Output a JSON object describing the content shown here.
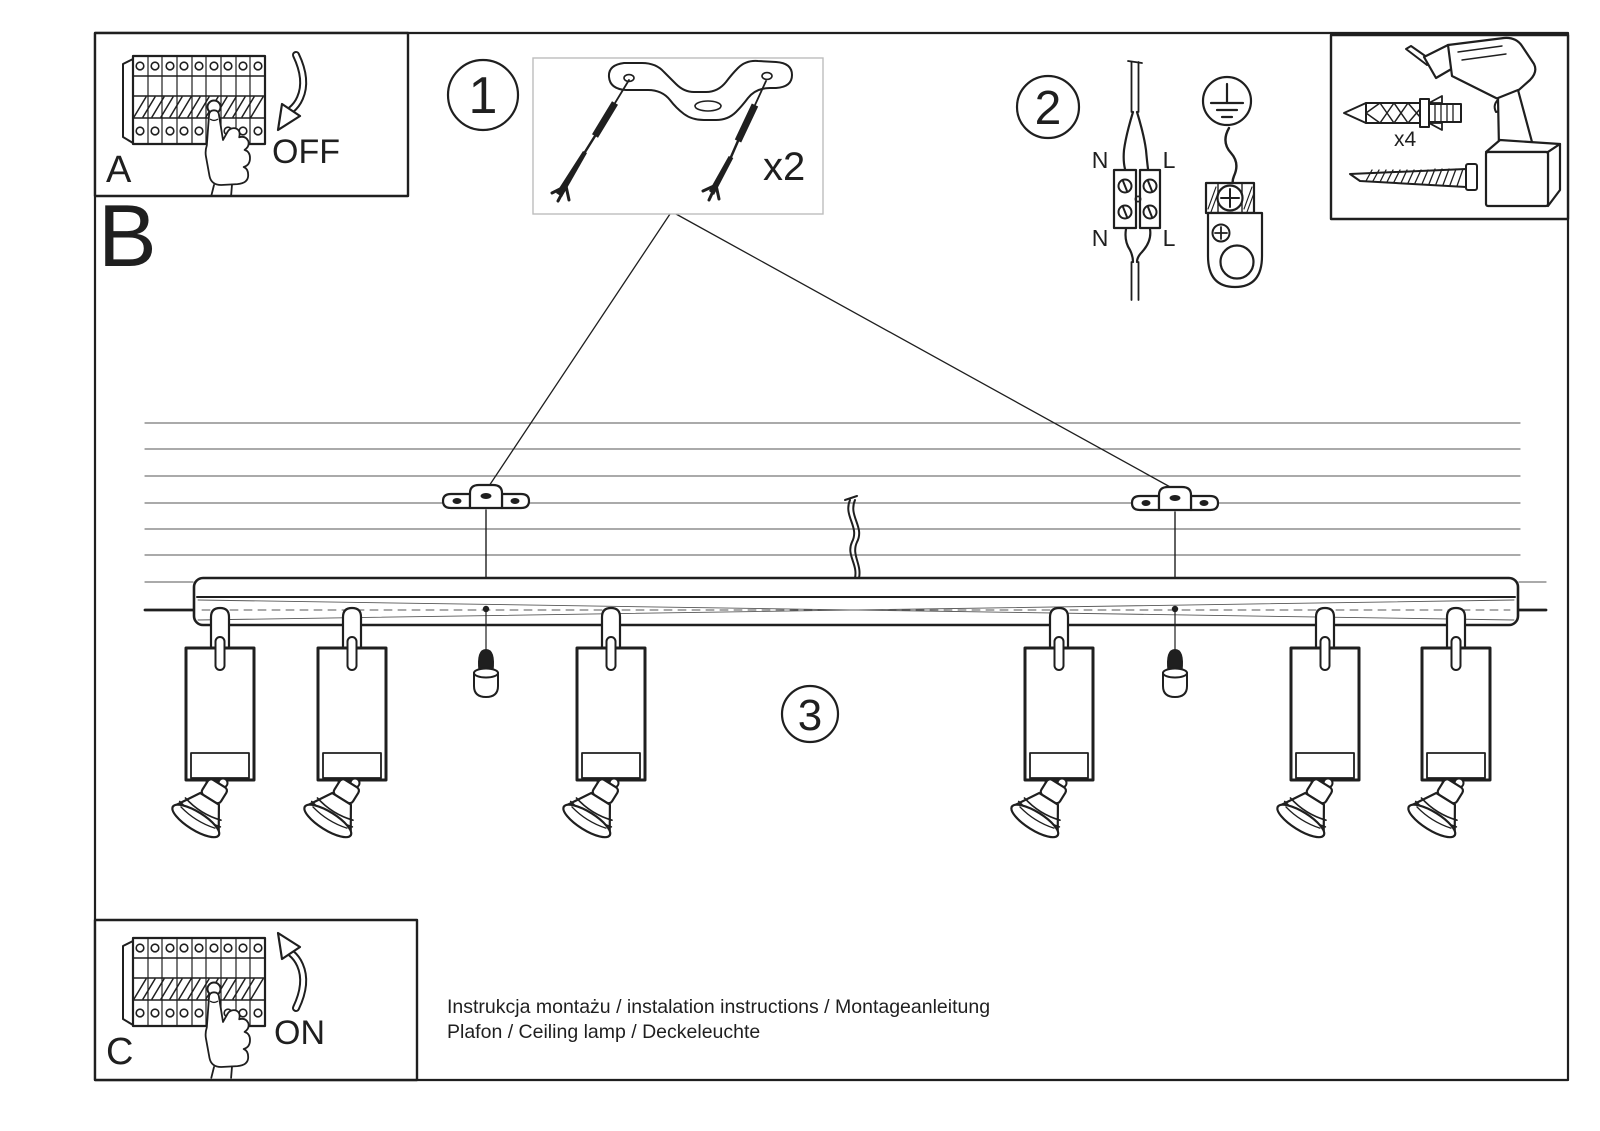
{
  "colors": {
    "ink": "#1f1f1f",
    "paper": "#ffffff",
    "parts_box_frame": "#bdbdbd"
  },
  "panel_a": {
    "label": "A",
    "action": "OFF"
  },
  "panel_c": {
    "label": "C",
    "action": "ON"
  },
  "section_b": {
    "label": "B"
  },
  "step_1": {
    "number": "1",
    "quantity_label": "x2"
  },
  "step_2": {
    "number": "2",
    "terminal_labels": {
      "top_left": "N",
      "top_right": "L",
      "bottom_left": "N",
      "bottom_right": "L"
    }
  },
  "step_3": {
    "number": "3"
  },
  "toolbox": {
    "plug_quantity_label": "x4"
  },
  "footer": {
    "line1": "Instrukcja montażu / instalation instructions / Montageanleitung",
    "line2": "Plafon / Ceiling lamp / Deckeleuchte"
  }
}
